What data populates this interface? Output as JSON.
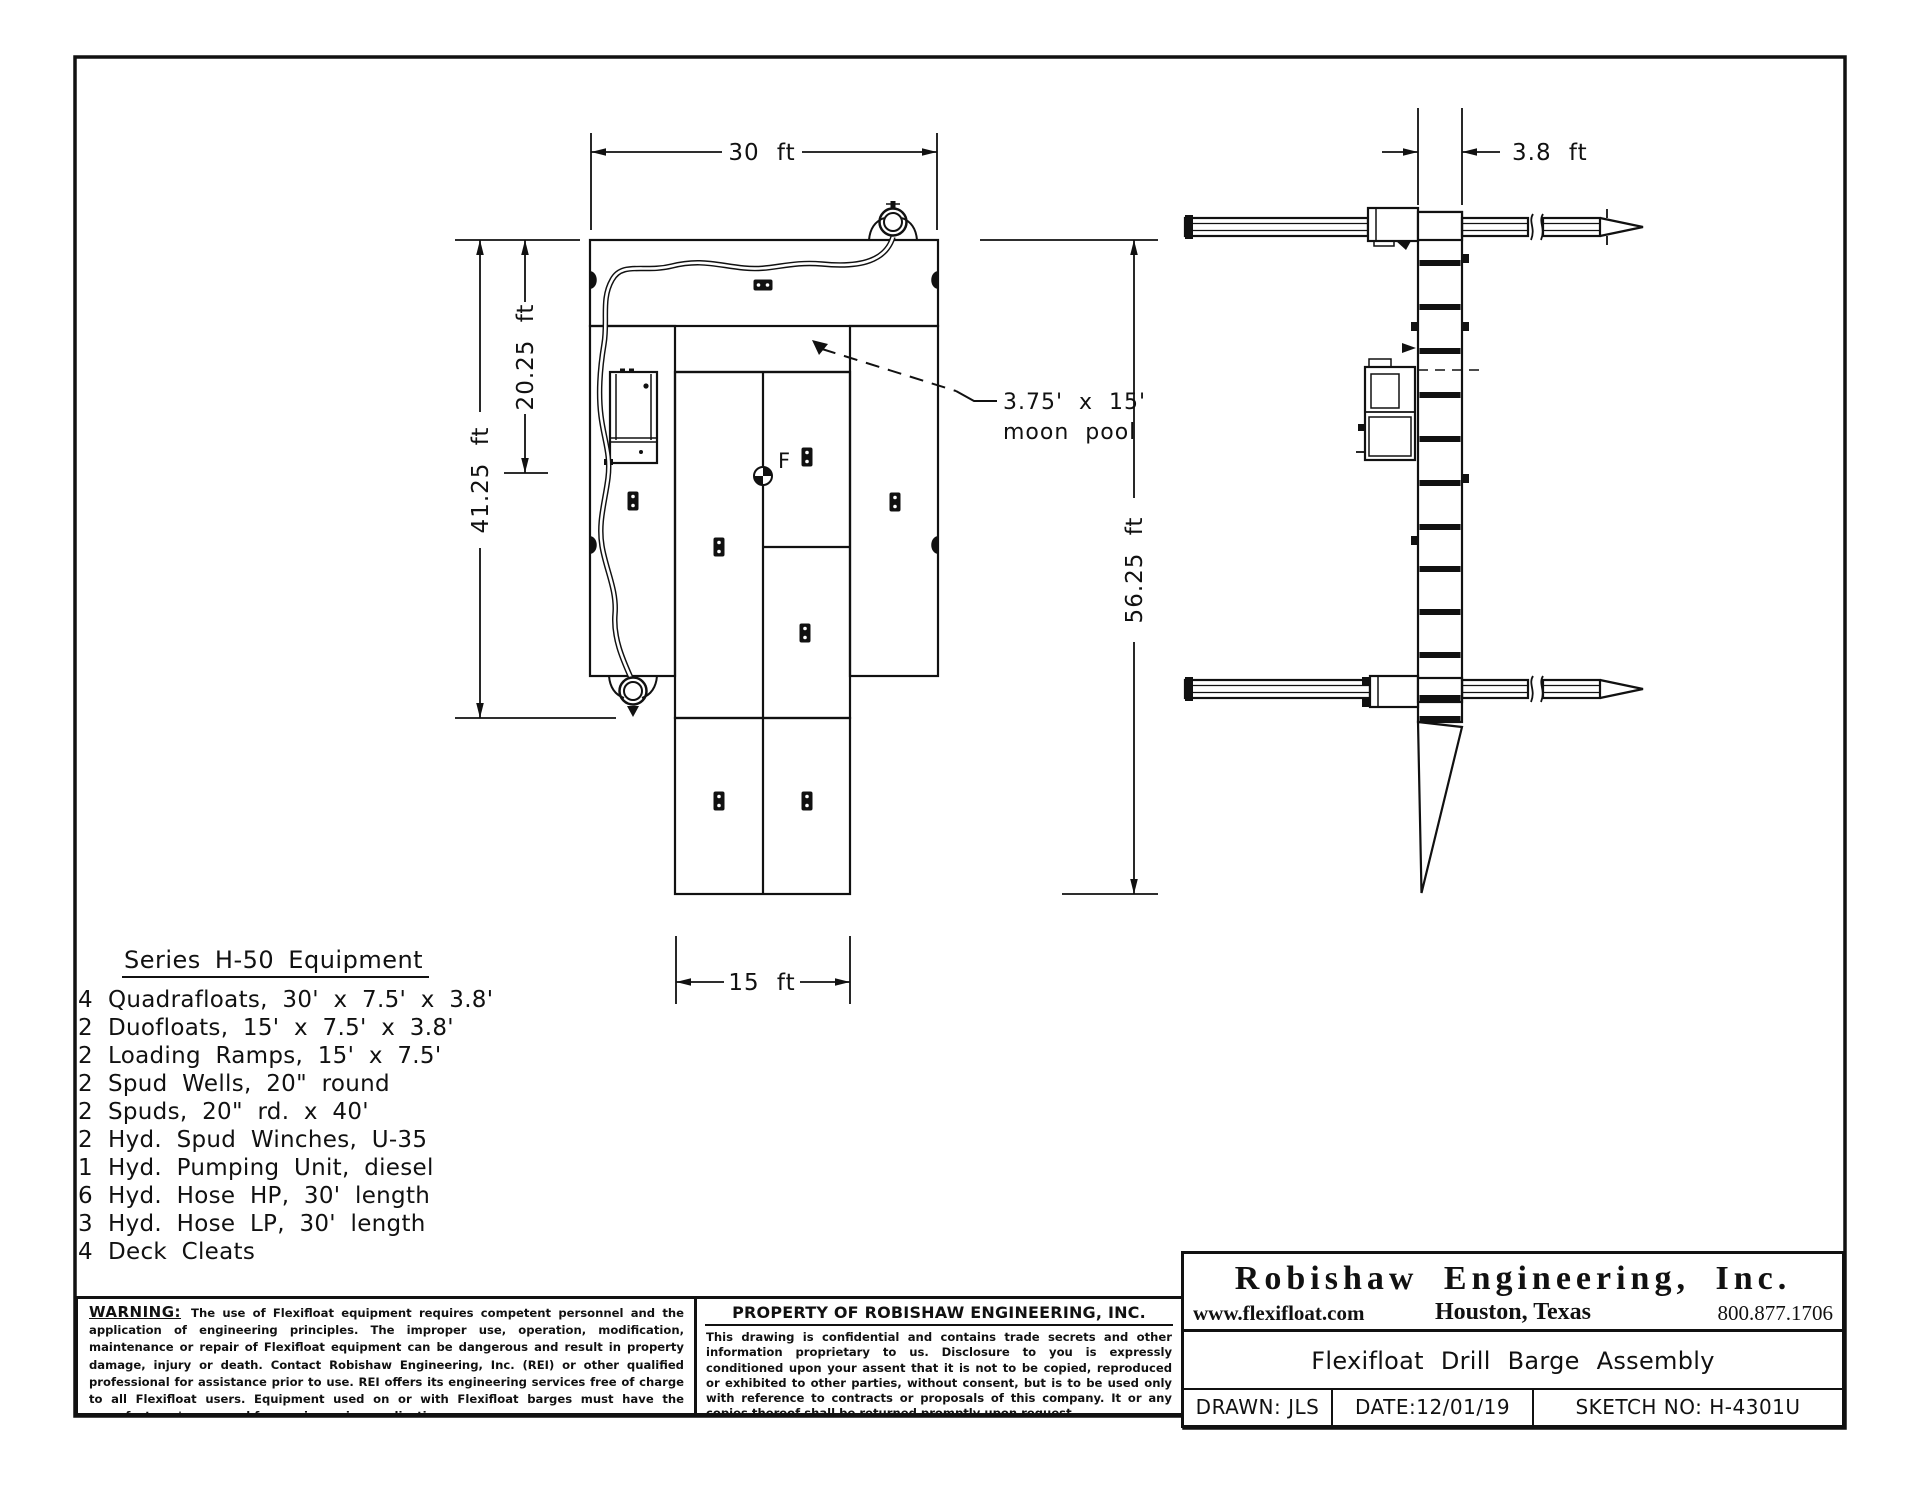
{
  "plan_view": {
    "dim_width": "30 ft",
    "dim_upper_height": "20.25 ft",
    "dim_main_height": "41.25 ft",
    "dim_extension_width": "15 ft",
    "dim_total_height": "56.25 ft",
    "moon_pool_size": "3.75' x 15'",
    "moon_pool_label": "moon pool",
    "flotation_label": "F"
  },
  "side_view": {
    "dim_hull_depth": "3.8 ft"
  },
  "equipment": {
    "title": "Series H-50 Equipment",
    "items": [
      {
        "qty": "4",
        "desc": "Quadrafloats, 30' x 7.5' x 3.8'"
      },
      {
        "qty": "2",
        "desc": "Duofloats, 15' x 7.5' x 3.8'"
      },
      {
        "qty": "2",
        "desc": "Loading Ramps, 15' x 7.5'"
      },
      {
        "qty": "2",
        "desc": "Spud Wells, 20\" round"
      },
      {
        "qty": "2",
        "desc": "Spuds, 20\" rd. x 40'"
      },
      {
        "qty": "2",
        "desc": "Hyd. Spud Winches, U-35"
      },
      {
        "qty": "1",
        "desc": "Hyd. Pumping Unit, diesel"
      },
      {
        "qty": "6",
        "desc": "Hyd. Hose HP, 30' length"
      },
      {
        "qty": "3",
        "desc": "Hyd. Hose LP, 30' length"
      },
      {
        "qty": "4",
        "desc": "Deck Cleats"
      }
    ]
  },
  "warning": {
    "label": "WARNING:",
    "text": "The use of Flexifloat equipment requires competent personnel and the application of engineering principles.  The improper use, operation, modification, maintenance or repair of Flexifloat equipment can be dangerous and result in property damage, injury or death.  Contact Robishaw Engineering, Inc. (REI) or other qualified professional for assistance prior to use.  REI offers its engineering services free of charge to all Flexifloat users. Equipment used on or with Flexifloat barges must have the manufacturer's approval for use in marine applications."
  },
  "property_notice": {
    "title": "PROPERTY OF ROBISHAW ENGINEERING, INC.",
    "text": "This drawing is confidential and contains trade secrets and other information proprietary to us.  Disclosure to you is expressly conditioned upon your assent that it is not to be copied, reproduced or exhibited to other parties, without consent, but is to be used only with reference to contracts or proposals of this company. It or any copies thereof shall be returned promptly upon request."
  },
  "title_block": {
    "company": "Robishaw Engineering, Inc.",
    "website": "www.flexifloat.com",
    "location": "Houston, Texas",
    "phone": "800.877.1706",
    "drawing_title": "Flexifloat Drill Barge Assembly",
    "drawn": "DRAWN: JLS",
    "date": "DATE:12/01/19",
    "sketch_no": "SKETCH NO: H-4301U"
  }
}
